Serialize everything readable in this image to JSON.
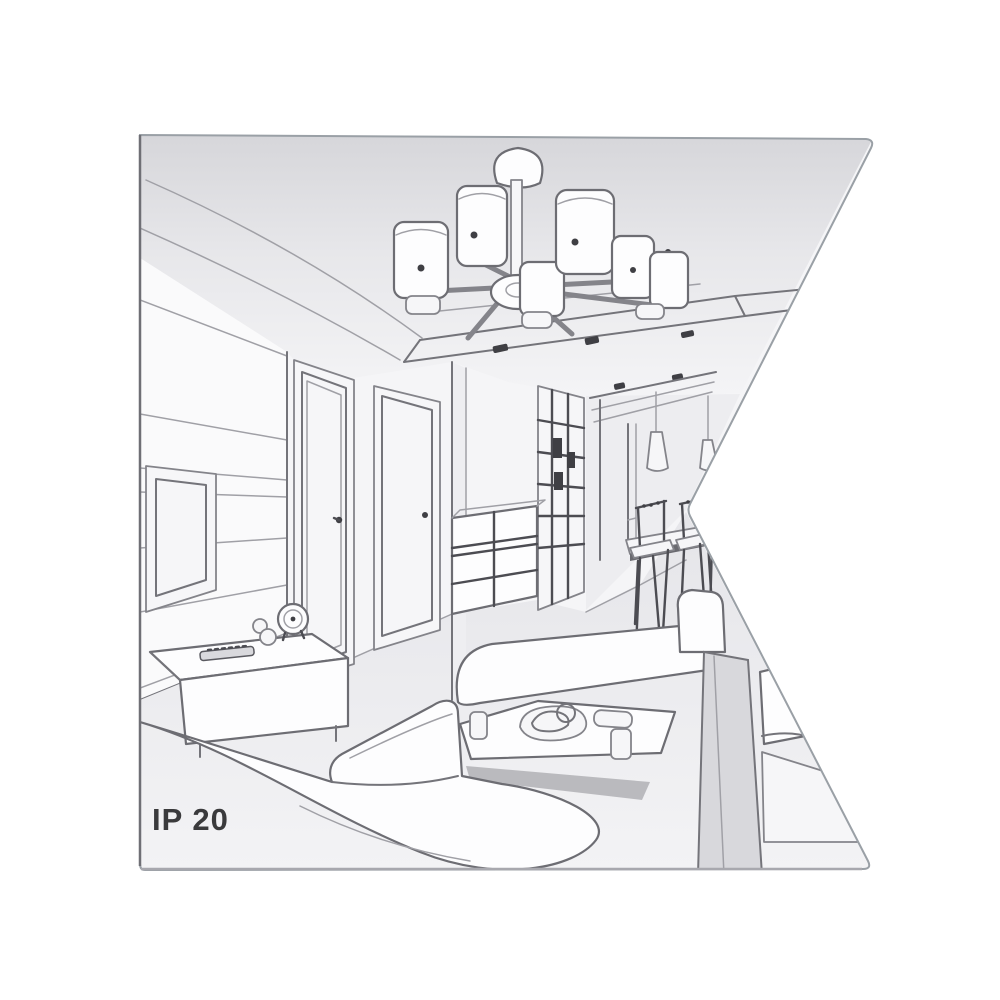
{
  "artwork": {
    "type": "interior-perspective-line-drawing",
    "description": "Grayscale sketch of a living room with a 6-shade ceiling chandelier, TV wall, doors, hallway wardrobe, dining corner with pendant lamps, sofas and coffee table",
    "label": {
      "ip_rating": "IP 20"
    },
    "colors": {
      "background": "#ffffff",
      "line": "#74747a",
      "line_dark": "#4c4c52",
      "wall": "#f5f5f7",
      "ceiling": "#d8d8dc",
      "floor": "#e9e9ec",
      "text": "#3a3a3c"
    },
    "scene_elements": [
      "chandelier",
      "ceiling-spotlights",
      "tv-screen",
      "media-console",
      "clock",
      "remote-control",
      "door-left",
      "door-right",
      "drawer-chest",
      "hallway-wardrobe",
      "pendant-lamps",
      "dining-table",
      "dining-chairs",
      "sofa-left",
      "sofa-right",
      "ottoman",
      "coffee-table",
      "serving-plate",
      "cups"
    ]
  }
}
